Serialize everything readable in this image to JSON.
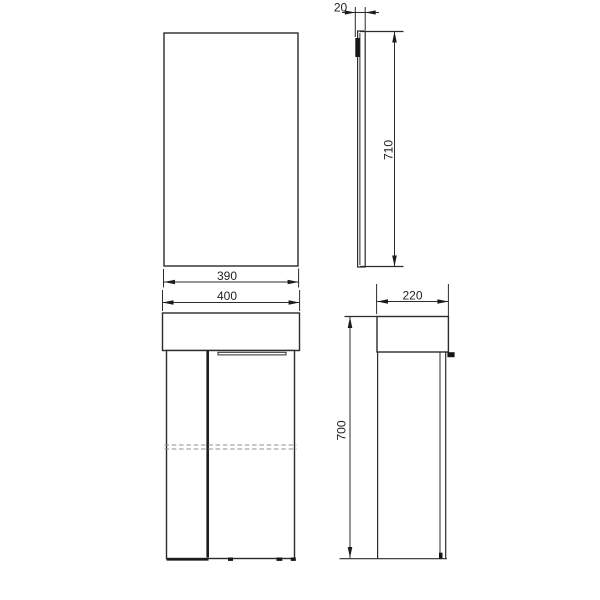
{
  "drawing": {
    "colors": {
      "background": "#ffffff",
      "line": "#2b2b2b",
      "dashed_line": "#8f8f8f",
      "text": "#222222"
    },
    "dimensions": {
      "mirror_width": "390",
      "mirror_thickness": "20",
      "mirror_height": "710",
      "cabinet_width": "400",
      "cabinet_depth": "220",
      "cabinet_height": "700"
    }
  }
}
